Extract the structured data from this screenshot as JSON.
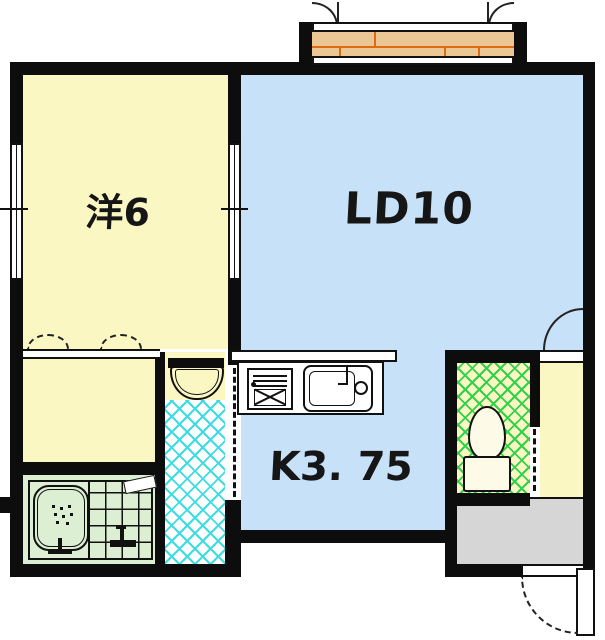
{
  "floorplan": {
    "rooms": {
      "western_room": {
        "label": "洋6"
      },
      "living_dining": {
        "label": "LD10"
      },
      "kitchen": {
        "label": "K3. 75"
      }
    },
    "fixtures": [
      "balcony-deck",
      "balcony-doors",
      "closet",
      "washbasin",
      "bathtub",
      "shower",
      "kitchen-stove",
      "kitchen-sink",
      "toilet",
      "hall-door",
      "entrance-door",
      "genkan-floor"
    ],
    "colors": {
      "wall_black": "#0d0d0d",
      "room_yellow": "#fbf7c3",
      "living_blue": "#c6e1f8",
      "bath_green": "#dcefd2",
      "genkan_gray": "#d6d6d6",
      "balcony_tan": "#ebc795",
      "balcony_joint_orange": "#e06a10",
      "washroom_lattice_cyan": "#3cdde2",
      "toilet_lattice_green": "#2fd24a"
    }
  }
}
